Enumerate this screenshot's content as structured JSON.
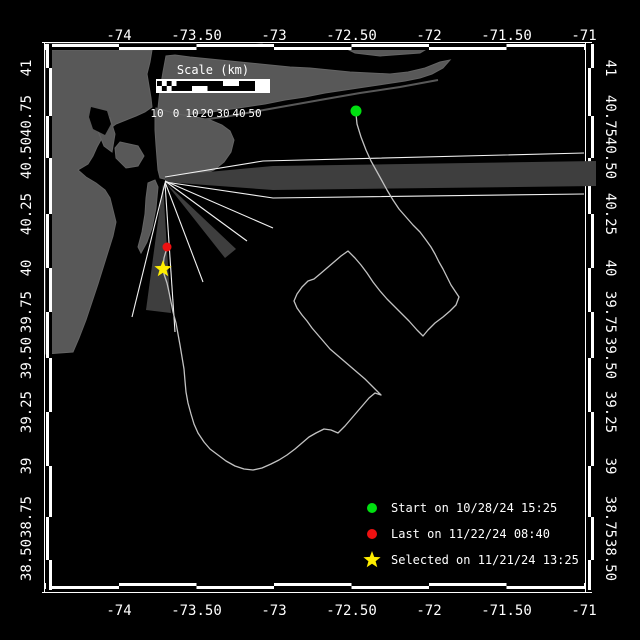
{
  "colors": {
    "background": "#000000",
    "land": "#585858",
    "beam_wedge": "#3e3e3e",
    "beam_line": "#f2f2f2",
    "track": "#c2c2c2",
    "frame": "#ffffff",
    "text": "#ffffff",
    "start_marker": "#00e010",
    "last_marker": "#ee1111",
    "selected_marker": "#ffee00"
  },
  "axes": {
    "lon_ticks": [
      {
        "label": "-74",
        "x": 119
      },
      {
        "label": "-73.50",
        "x": 196.5
      },
      {
        "label": "-73",
        "x": 274
      },
      {
        "label": "-72.50",
        "x": 351.5
      },
      {
        "label": "-72",
        "x": 429
      },
      {
        "label": "-71.50",
        "x": 506.5
      },
      {
        "label": "-71",
        "x": 584
      }
    ],
    "lat_ticks": [
      {
        "label": "41",
        "y": 68
      },
      {
        "label": "40.75",
        "y": 116
      },
      {
        "label": "40.50",
        "y": 158
      },
      {
        "label": "40.25",
        "y": 214
      },
      {
        "label": "40",
        "y": 268
      },
      {
        "label": "39.75",
        "y": 312
      },
      {
        "label": "39.50",
        "y": 358
      },
      {
        "label": "39.25",
        "y": 412
      },
      {
        "label": "39",
        "y": 466
      },
      {
        "label": "38.75",
        "y": 517
      },
      {
        "label": "38.50",
        "y": 560
      }
    ],
    "h_bounds": [
      46,
      119,
      196.5,
      274,
      351.5,
      429,
      506.5,
      584
    ],
    "v_bounds": [
      44,
      68,
      116,
      158,
      214,
      268,
      312,
      358,
      412,
      466,
      517,
      560,
      590
    ],
    "top_label_y": 40,
    "bottom_label_y": 615,
    "left_label_x": 31,
    "right_label_x": 606
  },
  "frame": {
    "top_bar": [
      44,
      50
    ],
    "bottom_bar": [
      583,
      589
    ],
    "left_bar": [
      46,
      52
    ],
    "right_bar": [
      588,
      594
    ],
    "thin_top_y": 42.5,
    "thin_bottom_y": 592.5,
    "thin_left_x": 44.5,
    "thin_right_x": 585.5
  },
  "scale_bar": {
    "title": "Scale (km)",
    "title_x": 213,
    "title_y": 74,
    "bar": {
      "x": 156,
      "y": 79,
      "w": 114,
      "h": 14
    },
    "inner_y1": 81,
    "inner_y2": 91,
    "checks": {
      "x1": 157,
      "x2": 176.5,
      "cols": 4,
      "rows": 2
    },
    "segments": [
      {
        "x1": 176.5,
        "x2": 192,
        "fill": "full"
      },
      {
        "x1": 192,
        "x2": 207.5,
        "fill": "top"
      },
      {
        "x1": 207.5,
        "x2": 223,
        "fill": "full"
      },
      {
        "x1": 223,
        "x2": 239,
        "fill": "bottom"
      },
      {
        "x1": 239,
        "x2": 255,
        "fill": "full"
      },
      {
        "x1": 255,
        "x2": 269,
        "fill": "none"
      }
    ],
    "labels": [
      {
        "text": "10",
        "x": 157
      },
      {
        "text": "0",
        "x": 176
      },
      {
        "text": "10",
        "x": 192
      },
      {
        "text": "20",
        "x": 207
      },
      {
        "text": "30",
        "x": 223
      },
      {
        "text": "40",
        "x": 239
      },
      {
        "text": "50",
        "x": 255
      }
    ],
    "label_y": 117
  },
  "legend": {
    "marker_x": 372,
    "text_x": 391,
    "marker_r": 5,
    "rows_y": [
      508,
      534,
      560
    ],
    "rows_y_text": [
      512,
      538,
      564
    ],
    "items": [
      {
        "marker": "circle",
        "color": "#00e010",
        "label": "Start on 10/28/24 15:25"
      },
      {
        "marker": "circle",
        "color": "#ee1111",
        "label": "Last on 11/22/24 08:40"
      },
      {
        "marker": "star",
        "color": "#ffee00",
        "label": "Selected on 11/21/24 13:25"
      }
    ]
  },
  "markers": {
    "start": {
      "x": 356,
      "y": 111,
      "r": 5.5,
      "color": "#00e010"
    },
    "last": {
      "x": 167,
      "y": 247,
      "r": 4.5,
      "color": "#ee1111"
    },
    "selected": {
      "x": 163,
      "y": 269,
      "r": 9,
      "color": "#ffee00"
    }
  },
  "beams": {
    "origin": [
      165,
      179
    ],
    "lines": [
      [
        [
          165,
          177
        ],
        [
          263,
          161
        ],
        [
          584,
          153
        ]
      ],
      [
        [
          165,
          182
        ],
        [
          273,
          198
        ],
        [
          584,
          194
        ]
      ],
      [
        [
          165,
          181
        ],
        [
          273,
          228
        ]
      ],
      [
        [
          165,
          181
        ],
        [
          247,
          241
        ]
      ],
      [
        [
          165,
          182
        ],
        [
          203,
          282
        ]
      ],
      [
        [
          165,
          183
        ],
        [
          175,
          332
        ]
      ],
      [
        [
          165,
          183
        ],
        [
          132,
          317
        ]
      ]
    ],
    "wedges": [
      [
        [
          165,
          176
        ],
        [
          273,
          166
        ],
        [
          596,
          161
        ],
        [
          596,
          186
        ],
        [
          273,
          190
        ],
        [
          165,
          182
        ]
      ],
      [
        [
          165,
          182
        ],
        [
          236,
          249
        ],
        [
          225,
          258
        ]
      ],
      [
        [
          163,
          184
        ],
        [
          171,
          313
        ],
        [
          146,
          310
        ]
      ]
    ]
  },
  "geo": {
    "land": [
      {
        "name": "connecticut-shore",
        "pts": [
          [
            46,
            44
          ],
          [
            196,
            44
          ],
          [
            196,
            49
          ],
          [
            120,
            50
          ],
          [
            46,
            50
          ]
        ]
      },
      {
        "name": "sound-islet-1",
        "pts": [
          [
            250,
            45
          ],
          [
            262,
            44
          ],
          [
            270,
            47
          ],
          [
            258,
            49
          ],
          [
            248,
            48
          ]
        ]
      },
      {
        "name": "sound-islet-2",
        "pts": [
          [
            296,
            45
          ],
          [
            308,
            45
          ],
          [
            304,
            49
          ],
          [
            294,
            48
          ]
        ]
      },
      {
        "name": "north-shore-patch",
        "pts": [
          [
            345,
            48
          ],
          [
            395,
            46
          ],
          [
            430,
            47
          ],
          [
            420,
            53
          ],
          [
            380,
            56
          ],
          [
            355,
            53
          ]
        ]
      },
      {
        "name": "long-island",
        "pts": [
          [
            166,
            56
          ],
          [
            163,
            72
          ],
          [
            160,
            90
          ],
          [
            158,
            108
          ],
          [
            157,
            122
          ],
          [
            168,
            118
          ],
          [
            185,
            115
          ],
          [
            205,
            113
          ],
          [
            225,
            110
          ],
          [
            245,
            107
          ],
          [
            265,
            104
          ],
          [
            285,
            100
          ],
          [
            305,
            97
          ],
          [
            325,
            93
          ],
          [
            345,
            90
          ],
          [
            365,
            87
          ],
          [
            385,
            84
          ],
          [
            405,
            81
          ],
          [
            420,
            78
          ],
          [
            432,
            74
          ],
          [
            443,
            68
          ],
          [
            450,
            60
          ],
          [
            440,
            62
          ],
          [
            425,
            68
          ],
          [
            408,
            72
          ],
          [
            390,
            74
          ],
          [
            370,
            73
          ],
          [
            350,
            72
          ],
          [
            330,
            70
          ],
          [
            310,
            68
          ],
          [
            290,
            67
          ],
          [
            270,
            65
          ],
          [
            250,
            63
          ],
          [
            230,
            61
          ],
          [
            210,
            59
          ],
          [
            190,
            57
          ],
          [
            175,
            55
          ]
        ]
      },
      {
        "name": "brooklyn-rockaway",
        "pts": [
          [
            156,
            108
          ],
          [
            170,
            112
          ],
          [
            183,
            115
          ],
          [
            196,
            117
          ],
          [
            210,
            120
          ],
          [
            222,
            125
          ],
          [
            230,
            131
          ],
          [
            234,
            140
          ],
          [
            231,
            152
          ],
          [
            224,
            162
          ],
          [
            214,
            170
          ],
          [
            200,
            176
          ],
          [
            186,
            180
          ],
          [
            172,
            181
          ],
          [
            160,
            178
          ],
          [
            158,
            170
          ],
          [
            157,
            158
          ],
          [
            156,
            145
          ],
          [
            155,
            130
          ],
          [
            155,
            118
          ]
        ]
      },
      {
        "name": "new-jersey",
        "pts": [
          [
            46,
            50
          ],
          [
            152,
            50
          ],
          [
            150,
            62
          ],
          [
            147,
            74
          ],
          [
            149,
            86
          ],
          [
            151,
            98
          ],
          [
            152,
            107
          ],
          [
            145,
            112
          ],
          [
            136,
            116
          ],
          [
            126,
            120
          ],
          [
            116,
            124
          ],
          [
            108,
            130
          ],
          [
            102,
            138
          ],
          [
            97,
            147
          ],
          [
            93,
            156
          ],
          [
            88,
            164
          ],
          [
            78,
            170
          ],
          [
            86,
            177
          ],
          [
            96,
            183
          ],
          [
            105,
            190
          ],
          [
            110,
            198
          ],
          [
            113,
            210
          ],
          [
            116,
            222
          ],
          [
            113,
            236
          ],
          [
            108,
            252
          ],
          [
            103,
            268
          ],
          [
            98,
            284
          ],
          [
            92,
            302
          ],
          [
            86,
            320
          ],
          [
            79,
            338
          ],
          [
            73,
            352
          ],
          [
            46,
            354
          ]
        ]
      },
      {
        "name": "manhattan",
        "pts": [
          [
            98,
            116
          ],
          [
            110,
            118
          ],
          [
            115,
            134
          ],
          [
            112,
            152
          ],
          [
            104,
            146
          ],
          [
            98,
            131
          ]
        ]
      },
      {
        "name": "staten-island",
        "pts": [
          [
            120,
            142
          ],
          [
            138,
            146
          ],
          [
            144,
            156
          ],
          [
            138,
            166
          ],
          [
            126,
            168
          ],
          [
            116,
            158
          ],
          [
            115,
            148
          ]
        ]
      },
      {
        "name": "sandy-hook",
        "pts": [
          [
            148,
            183
          ],
          [
            155,
            180
          ],
          [
            158,
            187
          ],
          [
            156,
            208
          ],
          [
            152,
            228
          ],
          [
            147,
            242
          ],
          [
            141,
            253
          ],
          [
            138,
            247
          ],
          [
            142,
            232
          ],
          [
            145,
            214
          ],
          [
            146,
            198
          ]
        ]
      }
    ],
    "water": [
      {
        "name": "newark-bay",
        "pts": [
          [
            91,
            107
          ],
          [
            107,
            111
          ],
          [
            111,
            124
          ],
          [
            105,
            135
          ],
          [
            93,
            129
          ],
          [
            89,
            117
          ]
        ]
      }
    ],
    "barrier_island": [
      [
        186,
        122
      ],
      [
        230,
        116
      ],
      [
        275,
        108
      ],
      [
        320,
        100
      ],
      [
        360,
        93
      ],
      [
        400,
        87
      ],
      [
        438,
        80
      ]
    ]
  },
  "track": [
    [
      356,
      114
    ],
    [
      357,
      124
    ],
    [
      361,
      137
    ],
    [
      366,
      150
    ],
    [
      371,
      161
    ],
    [
      376,
      170
    ],
    [
      381,
      179
    ],
    [
      387,
      190
    ],
    [
      393,
      200
    ],
    [
      399,
      209
    ],
    [
      406,
      217
    ],
    [
      413,
      225
    ],
    [
      420,
      232
    ],
    [
      426,
      240
    ],
    [
      431,
      247
    ],
    [
      435,
      254
    ],
    [
      439,
      262
    ],
    [
      443,
      269
    ],
    [
      447,
      277
    ],
    [
      451,
      285
    ],
    [
      455,
      291
    ],
    [
      459,
      297
    ],
    [
      456,
      305
    ],
    [
      450,
      311
    ],
    [
      443,
      317
    ],
    [
      435,
      323
    ],
    [
      428,
      330
    ],
    [
      423,
      336
    ],
    [
      417,
      330
    ],
    [
      409,
      321
    ],
    [
      401,
      313
    ],
    [
      394,
      306
    ],
    [
      387,
      299
    ],
    [
      380,
      291
    ],
    [
      373,
      282
    ],
    [
      367,
      273
    ],
    [
      361,
      265
    ],
    [
      355,
      258
    ],
    [
      348,
      251
    ],
    [
      341,
      256
    ],
    [
      334,
      262
    ],
    [
      327,
      268
    ],
    [
      320,
      274
    ],
    [
      314,
      279
    ],
    [
      308,
      281
    ],
    [
      302,
      287
    ],
    [
      297,
      294
    ],
    [
      294,
      301
    ],
    [
      297,
      308
    ],
    [
      302,
      315
    ],
    [
      307,
      321
    ],
    [
      312,
      328
    ],
    [
      318,
      335
    ],
    [
      324,
      342
    ],
    [
      330,
      349
    ],
    [
      337,
      355
    ],
    [
      344,
      361
    ],
    [
      351,
      367
    ],
    [
      358,
      373
    ],
    [
      365,
      379
    ],
    [
      371,
      385
    ],
    [
      377,
      391
    ],
    [
      381,
      395
    ],
    [
      375,
      393
    ],
    [
      369,
      398
    ],
    [
      363,
      405
    ],
    [
      357,
      412
    ],
    [
      351,
      419
    ],
    [
      345,
      426
    ],
    [
      338,
      433
    ],
    [
      331,
      430
    ],
    [
      324,
      429
    ],
    [
      316,
      433
    ],
    [
      309,
      437
    ],
    [
      302,
      443
    ],
    [
      295,
      449
    ],
    [
      287,
      455
    ],
    [
      279,
      460
    ],
    [
      271,
      464
    ],
    [
      262,
      468
    ],
    [
      253,
      470
    ],
    [
      244,
      469
    ],
    [
      235,
      466
    ],
    [
      226,
      461
    ],
    [
      218,
      455
    ],
    [
      210,
      449
    ],
    [
      204,
      442
    ],
    [
      198,
      433
    ],
    [
      194,
      424
    ],
    [
      191,
      414
    ],
    [
      188,
      403
    ],
    [
      186,
      392
    ],
    [
      185,
      381
    ],
    [
      184,
      369
    ],
    [
      182,
      357
    ],
    [
      180,
      345
    ],
    [
      178,
      334
    ],
    [
      176,
      323
    ],
    [
      173,
      312
    ],
    [
      171,
      302
    ],
    [
      169,
      292
    ],
    [
      167,
      283
    ],
    [
      164,
      274
    ],
    [
      163,
      267
    ],
    [
      164,
      258
    ],
    [
      166,
      251
    ],
    [
      167,
      247
    ]
  ]
}
